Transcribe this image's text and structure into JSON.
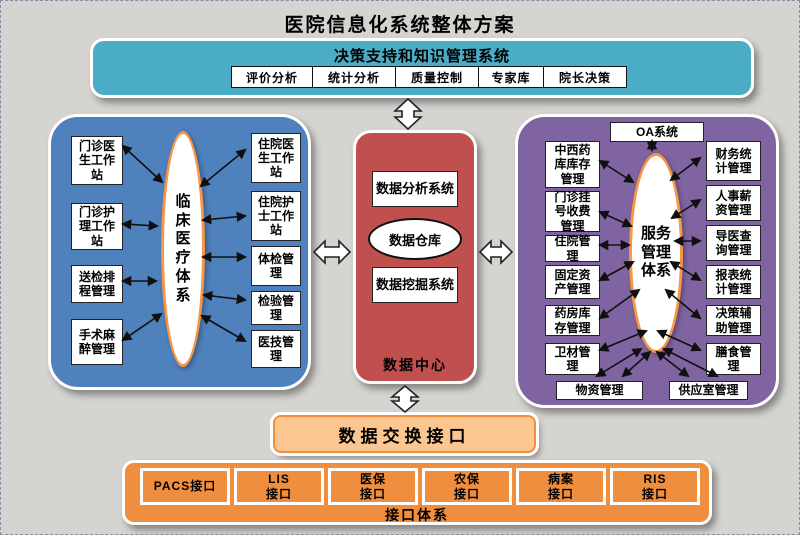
{
  "page": {
    "title": "医院信息化系统整体方案"
  },
  "decision": {
    "title": "决策支持和知识管理系统",
    "items": [
      "评价分析",
      "统计分析",
      "质量控制",
      "专家库",
      "院长决策"
    ]
  },
  "clinical": {
    "center": "临床医疗体系",
    "left_items": [
      "门诊医生工作站",
      "门诊护理工作站",
      "送检排程管理",
      "手术麻醉管理"
    ],
    "right_items": [
      "住院医生工作站",
      "住院护士工作站",
      "体检管理",
      "检验管理",
      "医技管理"
    ]
  },
  "data_center": {
    "analysis": "数据分析系统",
    "warehouse": "数据仓库",
    "mining": "数据挖掘系统",
    "label": "数据中心"
  },
  "service": {
    "oa": "OA系统",
    "center": "服务管理体系",
    "left_items": [
      "中西药库库存管理",
      "门诊挂号收费管理",
      "住院管理",
      "固定资产管理",
      "药房库存管理",
      "卫材管理"
    ],
    "right_items": [
      "财务统计管理",
      "人事薪资管理",
      "导医查询管理",
      "报表统计管理",
      "决策辅助管理",
      "膳食管理"
    ],
    "bottom_items": [
      "物资管理",
      "供应室管理"
    ]
  },
  "exchange": {
    "label": "数据交换接口"
  },
  "interfaces": {
    "label": "接口体系",
    "items": [
      [
        "PACS接口",
        ""
      ],
      [
        "LIS",
        "接口"
      ],
      [
        "医保",
        "接口"
      ],
      [
        "农保",
        "接口"
      ],
      [
        "病案",
        "接口"
      ],
      [
        "RIS",
        "接口"
      ]
    ]
  },
  "colors": {
    "teal": "#4bacc6",
    "blue": "#4f81bd",
    "red": "#c0504d",
    "purple": "#8064a2",
    "orange": "#ef8e3f",
    "light_orange": "#fbc690",
    "ellipse_border": "#f79646",
    "background": "#d6d4d1"
  }
}
